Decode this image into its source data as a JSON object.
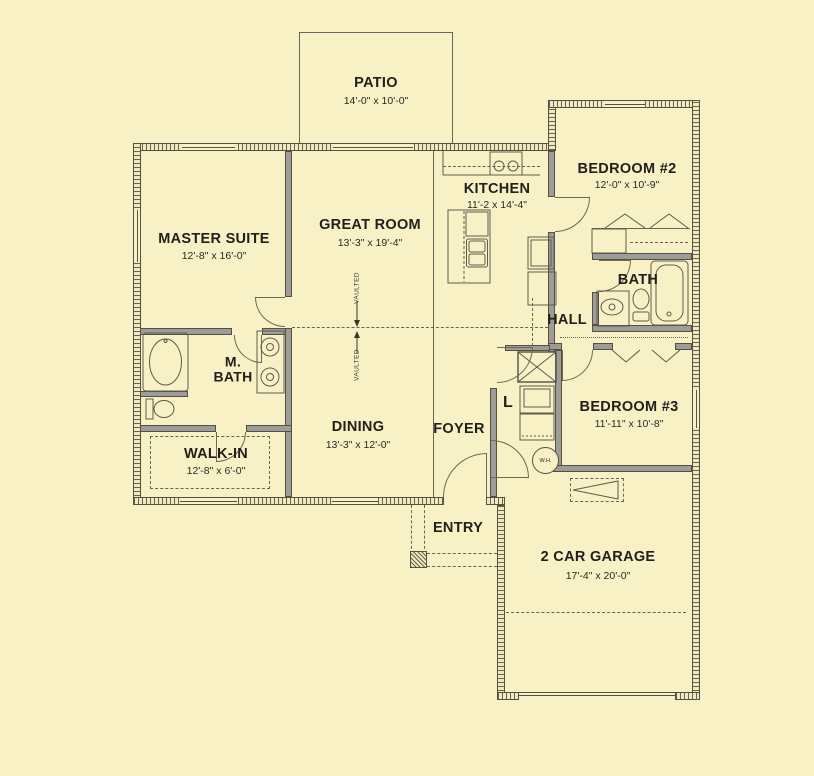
{
  "colors": {
    "background": "#f8f1c6",
    "wall_line": "#56503f",
    "interior_wall": "#9c9c9a",
    "text": "#21201b"
  },
  "rooms": {
    "patio": {
      "name": "PATIO",
      "dims": "14'-0\" x 10'-0\""
    },
    "master_suite": {
      "name": "MASTER SUITE",
      "dims": "12'-8\" x 16'-0\""
    },
    "great_room": {
      "name": "GREAT ROOM",
      "dims": "13'-3\" x 19'-4\""
    },
    "kitchen": {
      "name": "KITCHEN",
      "dims": "11'-2 x 14'-4\""
    },
    "bedroom2": {
      "name": "BEDROOM #2",
      "dims": "12'-0\" x 10'-9\""
    },
    "bath": {
      "name": "BATH"
    },
    "hall": {
      "name": "HALL"
    },
    "master_bath": {
      "name": "M. BATH"
    },
    "dining": {
      "name": "DINING",
      "dims": "13'-3\" x 12'-0\""
    },
    "foyer": {
      "name": "FOYER"
    },
    "laundry": {
      "name": "L"
    },
    "bedroom3": {
      "name": "BEDROOM #3",
      "dims": "11'-11\" x 10'-8\""
    },
    "walk_in": {
      "name": "WALK-IN",
      "dims": "12'-8\" x 6'-0\""
    },
    "entry": {
      "name": "ENTRY"
    },
    "garage": {
      "name": "2 CAR GARAGE",
      "dims": "17'-4\" x 20'-0\""
    }
  },
  "annotations": {
    "vaulted_upper": "VAULTED",
    "vaulted_lower": "VAULTED",
    "water_heater": "W.H."
  }
}
